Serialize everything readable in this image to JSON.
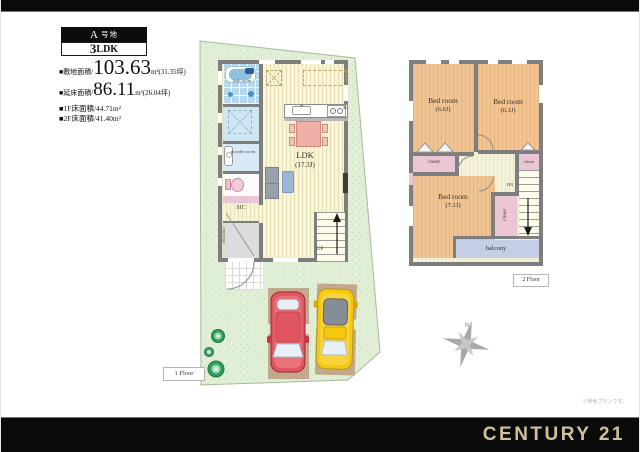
{
  "header": {
    "plot_letter": "A",
    "plot_suffix": "号地",
    "ldk_number": "3",
    "ldk_letters": "LDK",
    "site_area_label": "■敷地面積/",
    "site_area_value": "103.63",
    "site_area_suffix": "m²(31.35坪)",
    "total_area_label": "■延床面積/",
    "total_area_value": "86.11",
    "total_area_suffix": "m²(26.04坪)",
    "floor1_area": "■1F床面積/44.71m²",
    "floor2_area": "■2F床面積/41.40m²"
  },
  "floor1": {
    "tag": "1 Floor",
    "ldk_name": "LDK",
    "ldk_size": "(17.3J)",
    "bath": "bath room",
    "powder": "powder room",
    "sic": "SIC",
    "entrance": "entrance",
    "up": "UP"
  },
  "floor2": {
    "tag": "2 Floor",
    "bedrooms": [
      {
        "name": "Bed room",
        "size": "(6.6J)"
      },
      {
        "name": "Bed room",
        "size": "(6.1J)"
      },
      {
        "name": "Bed room",
        "size": "(7.1J)"
      }
    ],
    "closets": [
      "closet",
      "closet",
      "closet"
    ],
    "balcony": "balcony",
    "dn": "DN"
  },
  "compass": {
    "north": "N"
  },
  "footer": {
    "brand": "CENTURY 21",
    "disclaimer": "※参考プランです。"
  },
  "colors": {
    "bar_black": "#0b0b0b",
    "accent_gold": "#8a754a",
    "brand_gold": "#cfc19c",
    "site_green": "#e1efd7",
    "floor_yellow": "#f8f4d9",
    "room_orange": "#f1c493",
    "closet_pink": "#eac6d4",
    "balcony_blue": "#c6cee6",
    "parking_tan": "#c3a98c",
    "car_red": "#e25663",
    "car_yellow": "#f6c90f",
    "bush_green": "#2f9e5b",
    "wall_gray": "#7e7e7e"
  }
}
